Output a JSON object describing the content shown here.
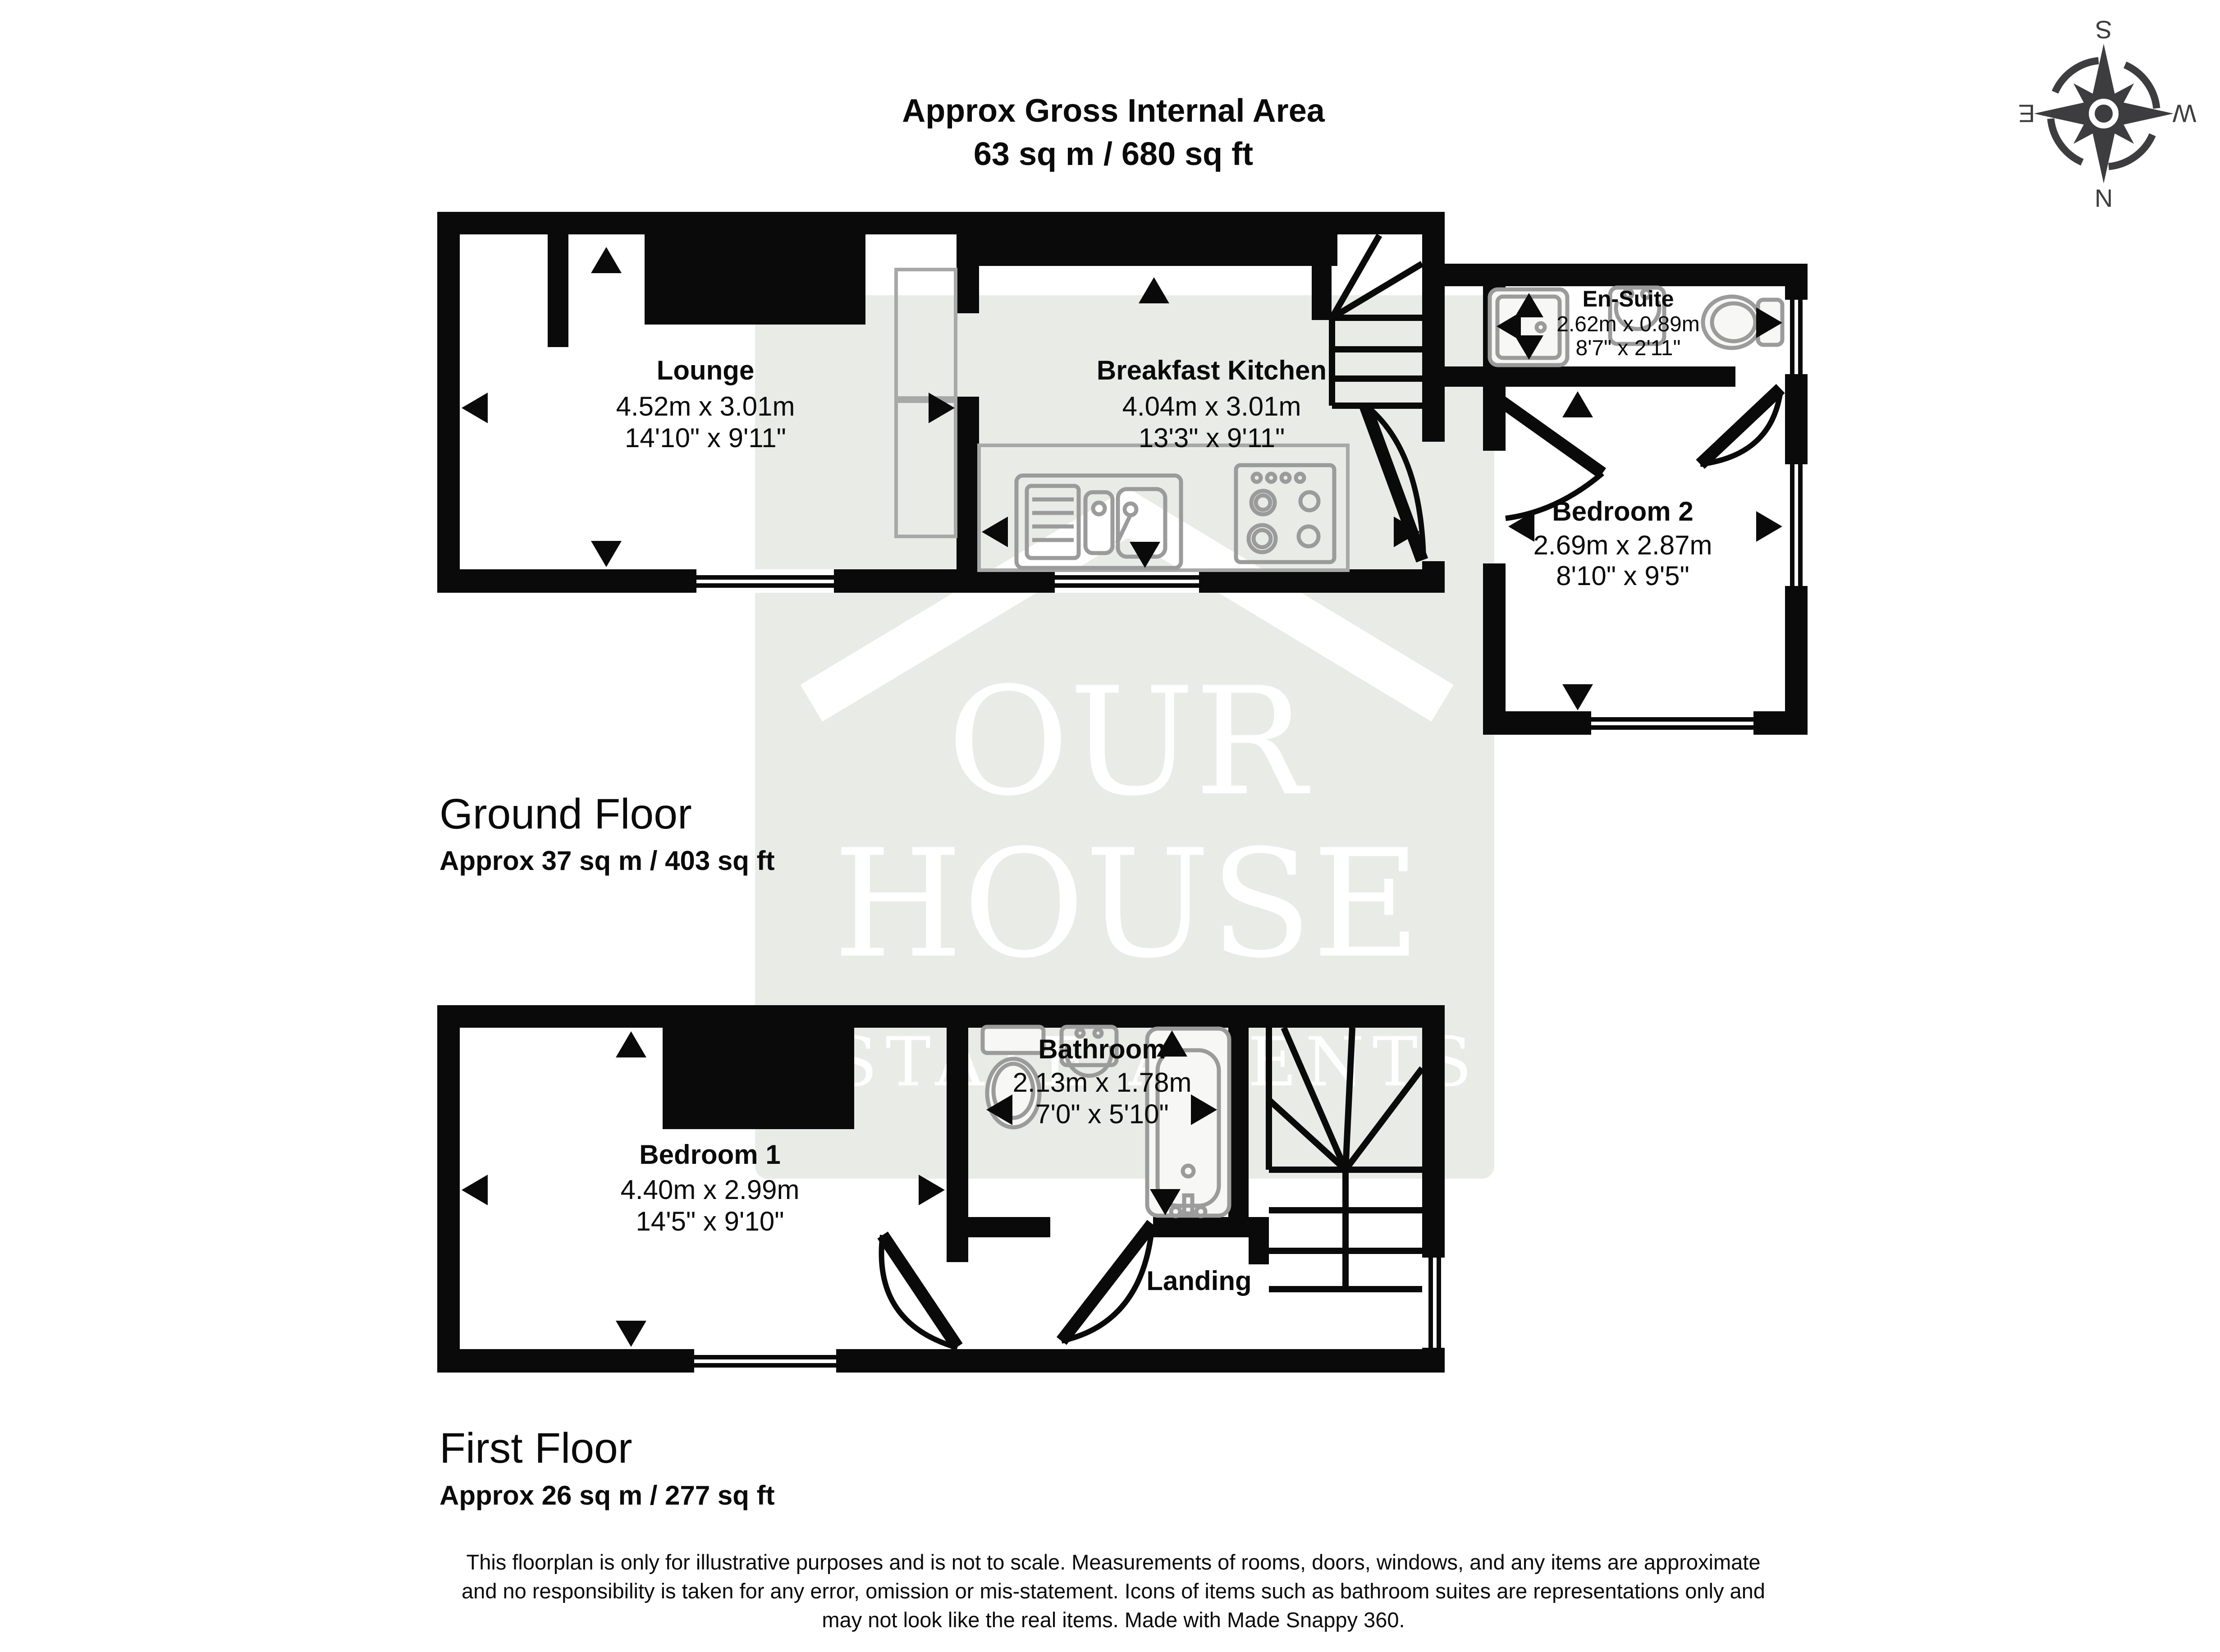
{
  "title": {
    "line1": "Approx Gross Internal Area",
    "line2": "63 sq m / 680 sq ft"
  },
  "compass": {
    "n": "N",
    "s": "S",
    "e": "E",
    "w": "W"
  },
  "watermark": {
    "line1": "OUR",
    "line2": "HOUSE",
    "line3": "ESTATE AGENTS"
  },
  "ground": {
    "label": "Ground Floor",
    "area": "Approx 37 sq m / 403 sq ft",
    "rooms": {
      "lounge": {
        "name": "Lounge",
        "metric": "4.52m x 3.01m",
        "imperial": "14'10\" x 9'11\""
      },
      "kitchen": {
        "name": "Breakfast Kitchen",
        "metric": "4.04m x 3.01m",
        "imperial": "13'3\" x 9'11\""
      },
      "ensuite": {
        "name": "En-Suite",
        "metric": "2.62m x 0.89m",
        "imperial": "8'7\" x 2'11\""
      },
      "bedroom2": {
        "name": "Bedroom 2",
        "metric": "2.69m x 2.87m",
        "imperial": "8'10\" x 9'5\""
      }
    }
  },
  "first": {
    "label": "First Floor",
    "area": "Approx 26 sq m / 277 sq ft",
    "rooms": {
      "bedroom1": {
        "name": "Bedroom 1",
        "metric": "4.40m x 2.99m",
        "imperial": "14'5\" x 9'10\""
      },
      "bathroom": {
        "name": "Bathroom",
        "metric": "2.13m x 1.78m",
        "imperial": "7'0\" x 5'10\""
      },
      "landing": {
        "name": "Landing"
      }
    }
  },
  "footer": {
    "line1": "This floorplan is only for illustrative purposes and is not to scale. Measurements of rooms, doors, windows, and any items are approximate",
    "line2": "and no responsibility is taken for any error, omission or mis-statement. Icons of items such as bathroom suites are representations only and",
    "line3": "may not look like the real items. Made with Made Snappy 360."
  },
  "colors": {
    "wall": "#0a0a0a",
    "watermark_bg": "#e9ebe7",
    "fixture_stroke": "#9b9b9b",
    "compass": "#3d3d3f"
  }
}
